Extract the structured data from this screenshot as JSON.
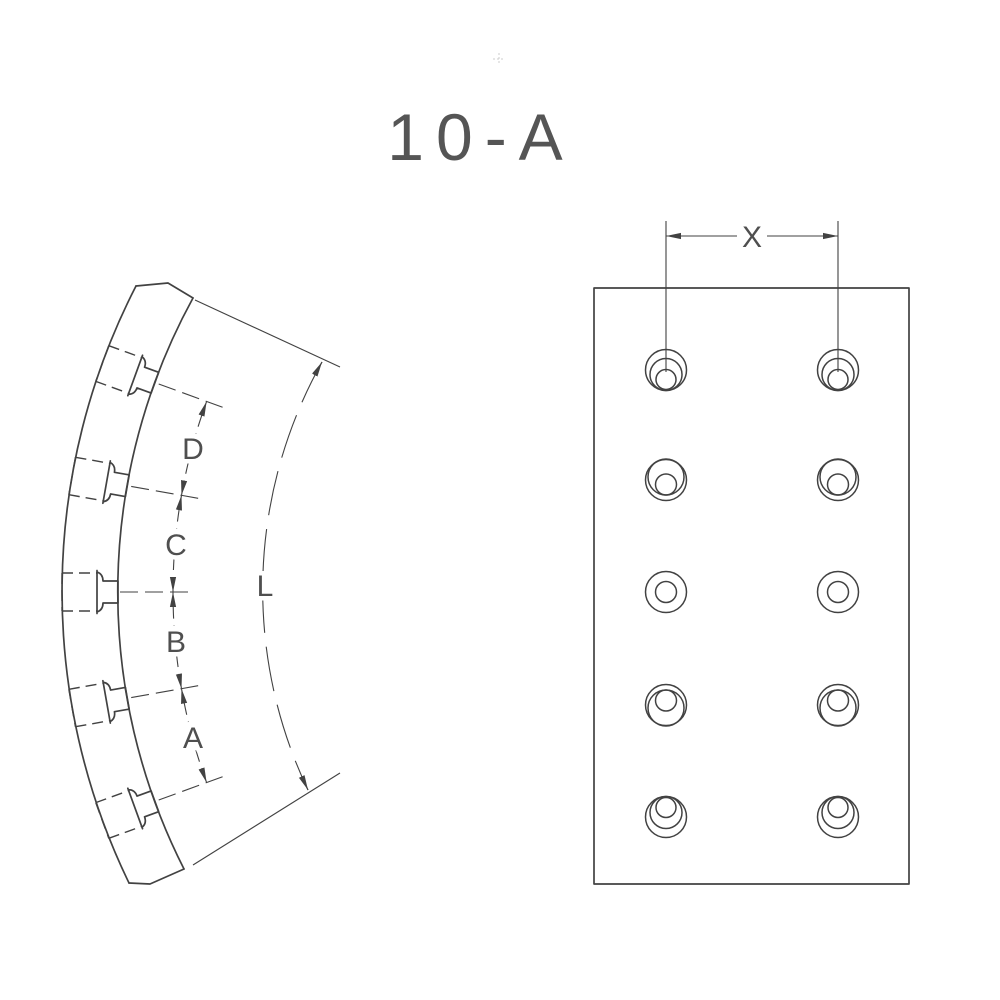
{
  "title": "10-A",
  "labels": {
    "x": "X",
    "d": "D",
    "c": "C",
    "b": "B",
    "a": "A",
    "l": "L"
  },
  "views": {
    "side": {
      "description": "curved lining segment side view with 5 mounting bolts",
      "bolt_count": 5,
      "chained_dimension_labels": [
        "D",
        "C",
        "B",
        "A"
      ],
      "arc_length_label": "L"
    },
    "plan": {
      "description": "flat plan view with countersunk rivet holes",
      "hole_columns": 2,
      "hole_rows": 5,
      "hole_count": 10,
      "column_spacing_label": "X"
    }
  },
  "colors": {
    "line": "#424242",
    "text": "#4f4f4f",
    "background": "#ffffff"
  }
}
